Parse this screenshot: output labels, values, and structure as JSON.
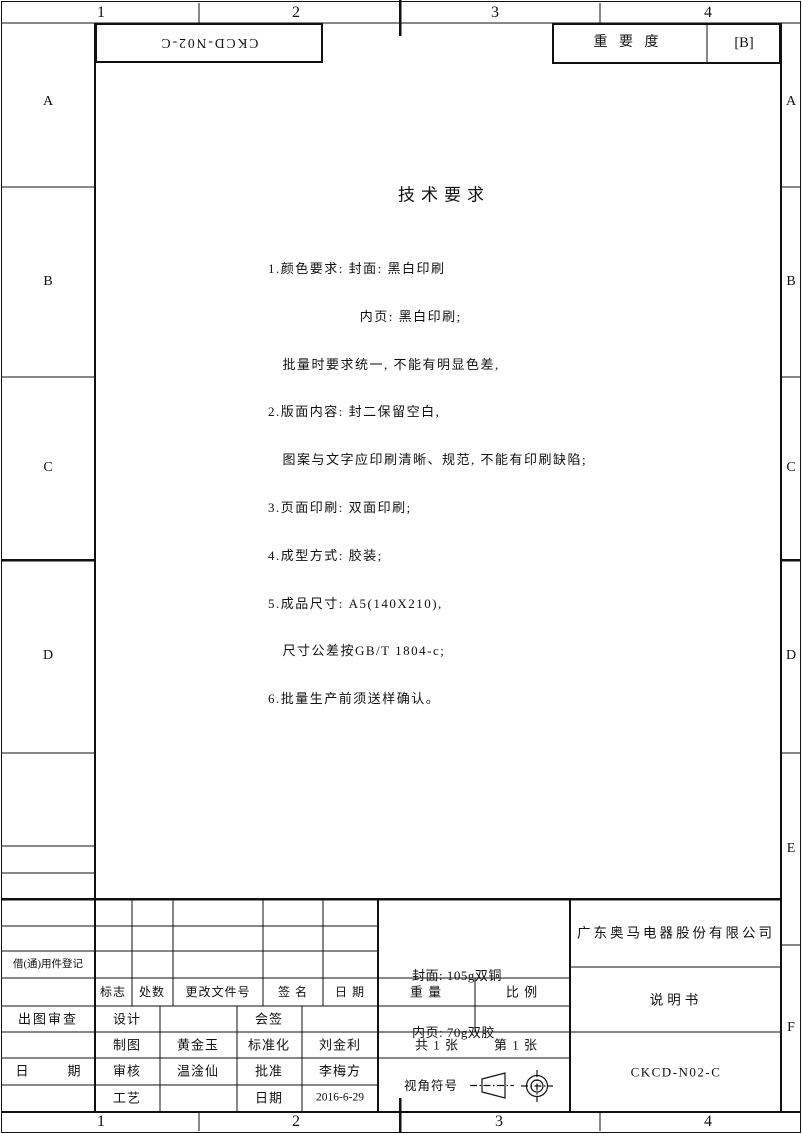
{
  "colors": {
    "ink": "#111111",
    "paper": "#ffffff"
  },
  "margins": {
    "top_zone_numbers": [
      "1",
      "2",
      "3",
      "4"
    ],
    "bottom_zone_numbers": [
      "1",
      "2",
      "3",
      "4"
    ],
    "left_zone_letters": [
      "A",
      "B",
      "C",
      "D"
    ],
    "right_zone_letters": [
      "A",
      "B",
      "C",
      "D",
      "E",
      "F"
    ]
  },
  "header": {
    "flipped_drawing_code": "CKCD-N02-C",
    "importance": {
      "label": "重 要 度",
      "value": "[B]"
    }
  },
  "tech": {
    "title": "技术要求",
    "lines": [
      "1.颜色要求: 封面: 黑白印刷",
      "　　　　　　 内页: 黑白印刷;",
      "　批量时要求统一, 不能有明显色差,",
      "2.版面内容: 封二保留空白,",
      "　图案与文字应印刷清晰、规范, 不能有印刷缺陷;",
      "3.页面印刷: 双面印刷;",
      "4.成型方式: 胶装;",
      "5.成品尺寸: A5(140X210),",
      "　尺寸公差按GB/T 1804-c;",
      "6.批量生产前须送样确认。"
    ]
  },
  "left_panel": {
    "borrow_register": "借(通)用件登记",
    "plot_review": "出图审查",
    "date": "日　　　期"
  },
  "titleblock": {
    "revision_header": [
      "标志",
      "处数",
      "更改文件号",
      "签 名",
      "日 期"
    ],
    "weight": "重 量",
    "scale": "比 例",
    "paper_spec": [
      "封面: 105g双铜",
      "内页: 70g双胶"
    ],
    "company": "广东奥马电器股份有限公司",
    "doc_title": "说明书",
    "drawing_no": "CKCD-N02-C",
    "total_sheets": "共 1 张",
    "sheet_no": "第 1 张",
    "view_symbol_label": "视角符号",
    "sig": [
      [
        "设计",
        "",
        "会签",
        ""
      ],
      [
        "制图",
        "黄金玉",
        "标准化",
        "刘金利"
      ],
      [
        "审核",
        "温淦仙",
        "批准",
        "李梅方"
      ],
      [
        "工艺",
        "",
        "日期",
        "2016-6-29"
      ]
    ]
  }
}
